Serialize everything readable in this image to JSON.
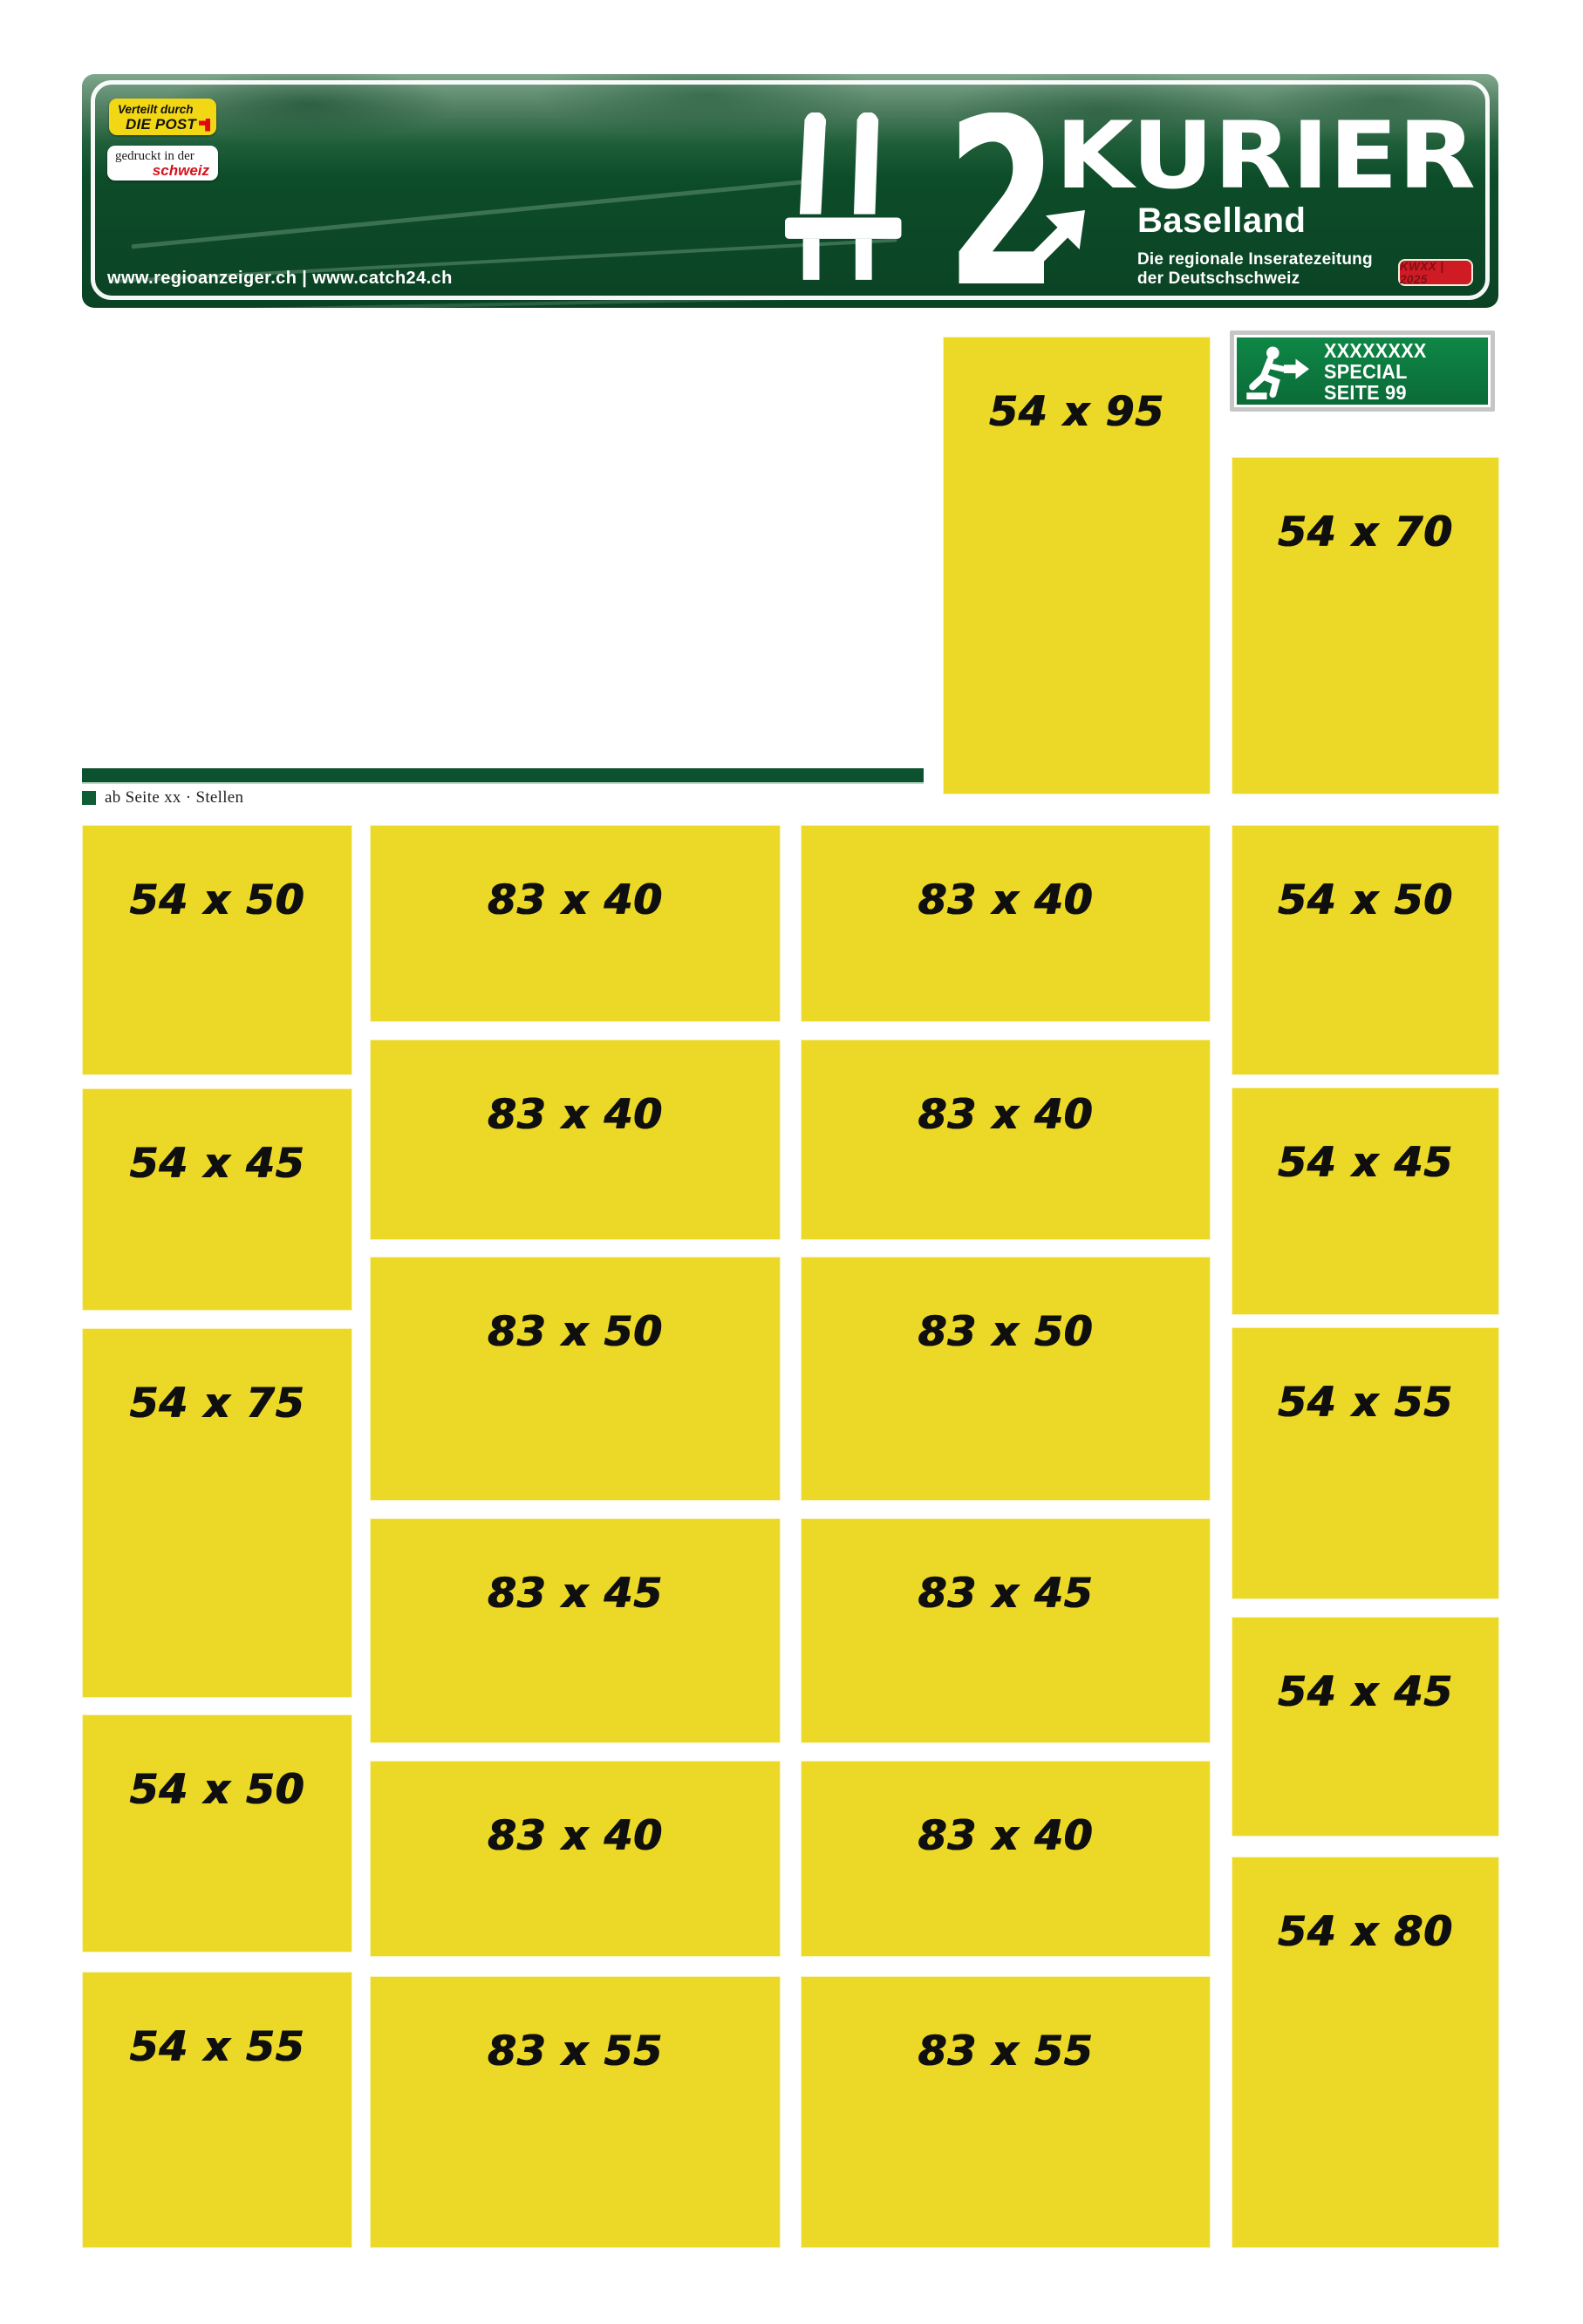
{
  "masthead": {
    "post_badge": {
      "line1": "Verteilt durch",
      "line2": "DIE POST"
    },
    "print_badge": {
      "line1": "gedruckt in der",
      "line2": "schweiz"
    },
    "urls": "www.regioanzeiger.ch | www.catch24.ch",
    "route_number": "2",
    "brand": "KURIER",
    "region": "Baselland",
    "tagline_line1": "Die regionale Inseratezeitung",
    "tagline_line2": "der Deutschschweiz",
    "issue_badge": "KWXX | 2025"
  },
  "special_sign": {
    "line1": "XXXXXXXX",
    "line2": "SPECIAL",
    "line3": "SEITE 99"
  },
  "section_marker": {
    "label": "ab Seite xx · Stellen"
  },
  "colors": {
    "ad_yellow": "#ecd927",
    "sign_green": "#0a4324",
    "exit_green": "#0e8746",
    "badge_red": "#cf1b24",
    "post_yellow": "#f2d714",
    "bar_green": "#0d5230"
  },
  "ad_slots": {
    "blocks": [
      {
        "label": "54 x 95"
      },
      {
        "label": "54 x 70"
      },
      {
        "label": "54 x 50"
      },
      {
        "label": "54 x 45"
      },
      {
        "label": "54 x 75"
      },
      {
        "label": "54 x 50"
      },
      {
        "label": "54 x 55"
      },
      {
        "label": "83 x 40"
      },
      {
        "label": "83 x 40"
      },
      {
        "label": "83 x 50"
      },
      {
        "label": "83 x 45"
      },
      {
        "label": "83 x 40"
      },
      {
        "label": "83 x 55"
      },
      {
        "label": "83 x 40"
      },
      {
        "label": "83 x 40"
      },
      {
        "label": "83 x 50"
      },
      {
        "label": "83 x 45"
      },
      {
        "label": "83 x 40"
      },
      {
        "label": "83 x 55"
      },
      {
        "label": "54 x 50"
      },
      {
        "label": "54 x 45"
      },
      {
        "label": "54 x 55"
      },
      {
        "label": "54 x 45"
      },
      {
        "label": "54 x 80"
      }
    ]
  }
}
